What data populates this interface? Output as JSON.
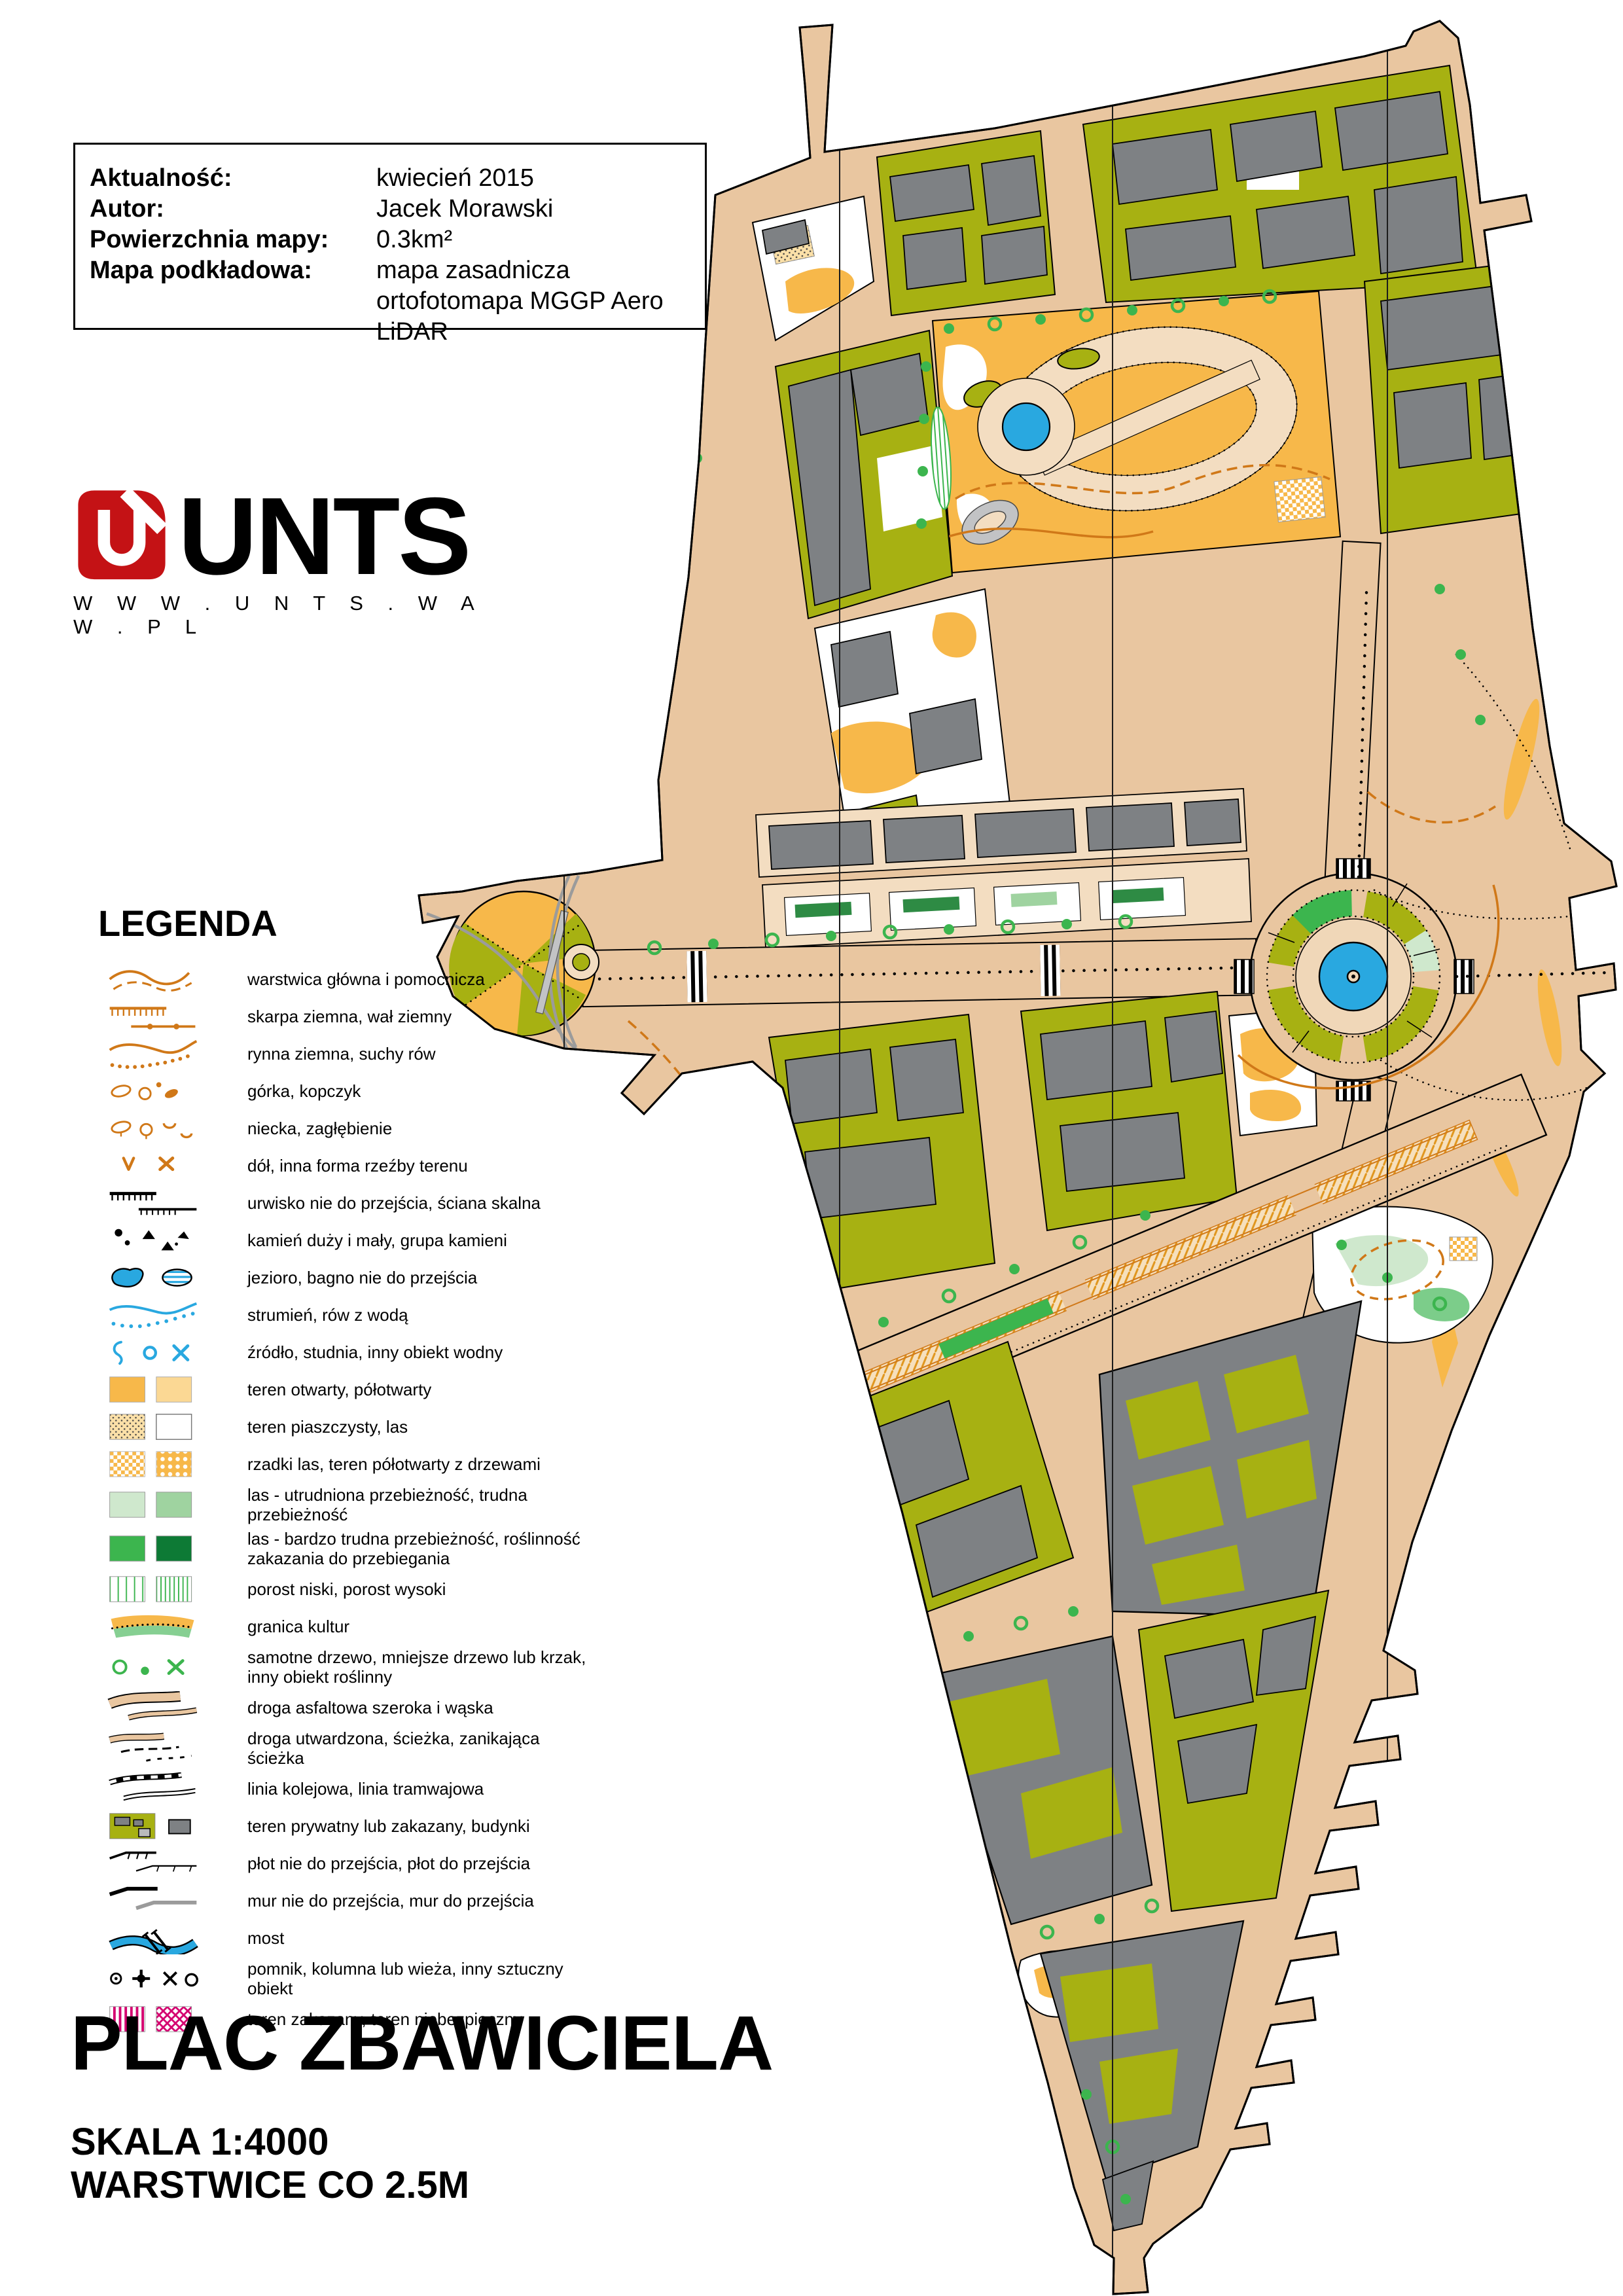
{
  "info_box": {
    "rows": [
      {
        "label": "Aktualność:",
        "value": "kwiecień 2015"
      },
      {
        "label": "Autor:",
        "value": "Jacek Morawski"
      },
      {
        "label": "Powierzchnia mapy:",
        "value": "0.3km²"
      },
      {
        "label": "Mapa podkładowa:",
        "value": "mapa zasadnicza\nortofotomapa MGGP Aero\nLiDAR"
      }
    ]
  },
  "logo": {
    "name": "UNTS",
    "url": "W W W . U N T S . W A W . P L",
    "accent": "#c41215"
  },
  "legend": {
    "title": "LEGENDA",
    "items": [
      {
        "icon": "contour-lines",
        "label": "warstwica główna i pomocnicza"
      },
      {
        "icon": "earth-bank",
        "label": "skarpa ziemna, wał ziemny"
      },
      {
        "icon": "erosion-gully",
        "label": "rynna ziemna, suchy rów"
      },
      {
        "icon": "knoll",
        "label": "górka, kopczyk"
      },
      {
        "icon": "depression",
        "label": "niecka, zagłębienie"
      },
      {
        "icon": "pit",
        "label": "dół, inna forma rzeźby terenu"
      },
      {
        "icon": "impassable-cliff",
        "label": "urwisko nie do przejścia, ściana skalna"
      },
      {
        "icon": "boulder",
        "label": "kamień duży i mały, grupa kamieni"
      },
      {
        "icon": "lake-marsh",
        "label": "jezioro, bagno nie do przejścia"
      },
      {
        "icon": "stream",
        "label": "strumień, rów z wodą"
      },
      {
        "icon": "water-feature",
        "label": "źródło, studnia, inny obiekt wodny"
      },
      {
        "icon": "open-land",
        "label": "teren otwarty, półotwarty"
      },
      {
        "icon": "sandy-ground",
        "label": "teren piaszczysty, las"
      },
      {
        "icon": "rough-open-trees",
        "label": "rzadki las, teren półotwarty z drzewami"
      },
      {
        "icon": "forest-slow",
        "label": "las - utrudniona przebieżność, trudna przebieżność"
      },
      {
        "icon": "forest-difficult",
        "label": "las - bardzo trudna przebieżność, roślinność zakazania do przebiegania"
      },
      {
        "icon": "undergrowth",
        "label": "porost niski, porost wysoki"
      },
      {
        "icon": "cultivation-boundary",
        "label": "granica kultur"
      },
      {
        "icon": "lone-tree",
        "label": "samotne drzewo, mniejsze drzewo lub krzak, inny obiekt roślinny"
      },
      {
        "icon": "paved-road",
        "label": "droga asfaltowa szeroka i wąska"
      },
      {
        "icon": "footpath",
        "label": "droga utwardzona, ścieżka, zanikająca ścieżka"
      },
      {
        "icon": "railway-tram",
        "label": "linia kolejowa, linia tramwajowa"
      },
      {
        "icon": "private-area-buildings",
        "label": "teren prywatny lub zakazany, budynki"
      },
      {
        "icon": "fence",
        "label": "płot nie do przejścia, płot do przejścia"
      },
      {
        "icon": "wall",
        "label": "mur nie do przejścia, mur do przejścia"
      },
      {
        "icon": "bridge",
        "label": "most"
      },
      {
        "icon": "monument",
        "label": "pomnik, kolumna lub wieża, inny sztuczny obiekt"
      },
      {
        "icon": "forbidden-area",
        "label": "teren zakazany, teren niebezpieczny"
      }
    ]
  },
  "titles": {
    "title": "PLAC ZBAWICIELA",
    "scale": "SKALA 1:4000",
    "contours": "WARSTWICE CO 2.5M"
  },
  "map": {
    "colors": {
      "road_tan": "#e9c6a0",
      "sidewalk": "#f3ddc1",
      "building_gray": "#7e8184",
      "canopy_gray": "#c2c3c5",
      "private_olive": "#a7b112",
      "open_orange": "#f7b84a",
      "semi_open": "#fbd894",
      "water_blue": "#29a8e0",
      "tree_green": "#3cb54e",
      "forest_light": "#cfe8cd",
      "forest_dark": "#0d7a35",
      "contour_orange": "#d07818",
      "forbidden_magenta": "#d4006f"
    },
    "landmarks": [
      "plac-zbawiciela-roundabout-fountain",
      "plac-politechniki-roundabout",
      "park-with-running-track-and-pond",
      "tram-boulevard"
    ]
  }
}
